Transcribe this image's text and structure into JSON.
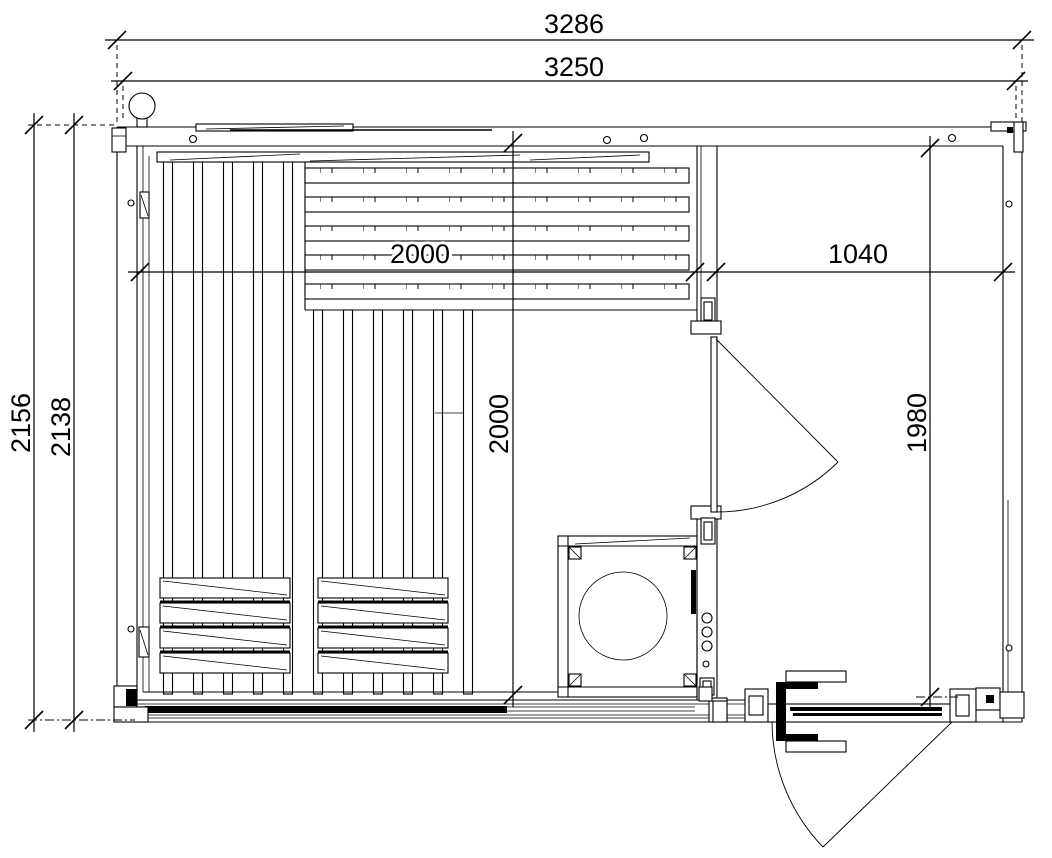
{
  "drawing": {
    "type": "architectural floor plan",
    "subject": "sauna cabin plan view",
    "background": "#ffffff",
    "line_color": "#000000",
    "dims": {
      "overall_width": "3286",
      "frame_width": "3250",
      "overall_depth": "2156",
      "frame_depth": "2138",
      "sauna_room_width": "2000",
      "sauna_room_depth": "2000",
      "dressing_room_width": "1040",
      "dressing_room_depth": "1980"
    }
  }
}
